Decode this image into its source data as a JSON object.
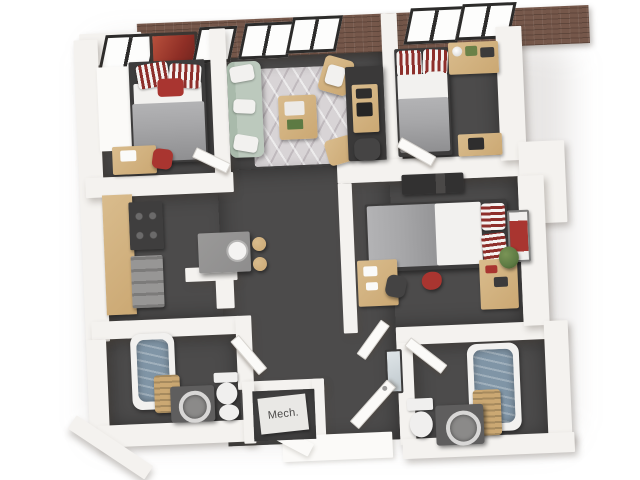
{
  "image": {
    "type": "3d-floorplan-render",
    "mech_label": "Mech.",
    "colors": {
      "background": "#ffffff",
      "wall": "#f4f2ef",
      "wall_bright": "#fbfaf8",
      "floor": "#4c4b4b",
      "brick": "#75574a",
      "window_frame": "#2c2b2a",
      "rug": "#d8d4d6",
      "sofa": "#bcc9bd",
      "wood": "#cba873",
      "wood_light": "#d9bc8d",
      "blanket": "#a6a6a8",
      "sheet": "#f2f1ef",
      "stripe_red": "#8e2f2b",
      "accent_red": "#a93530",
      "tub": "#8095a6",
      "steel": "#979695",
      "appliance": "#3f3e3e",
      "console": "#3a3939",
      "plant": "#5d7a43",
      "label_bg": "#e9e8e5",
      "label_text": "#4b4a49"
    }
  }
}
